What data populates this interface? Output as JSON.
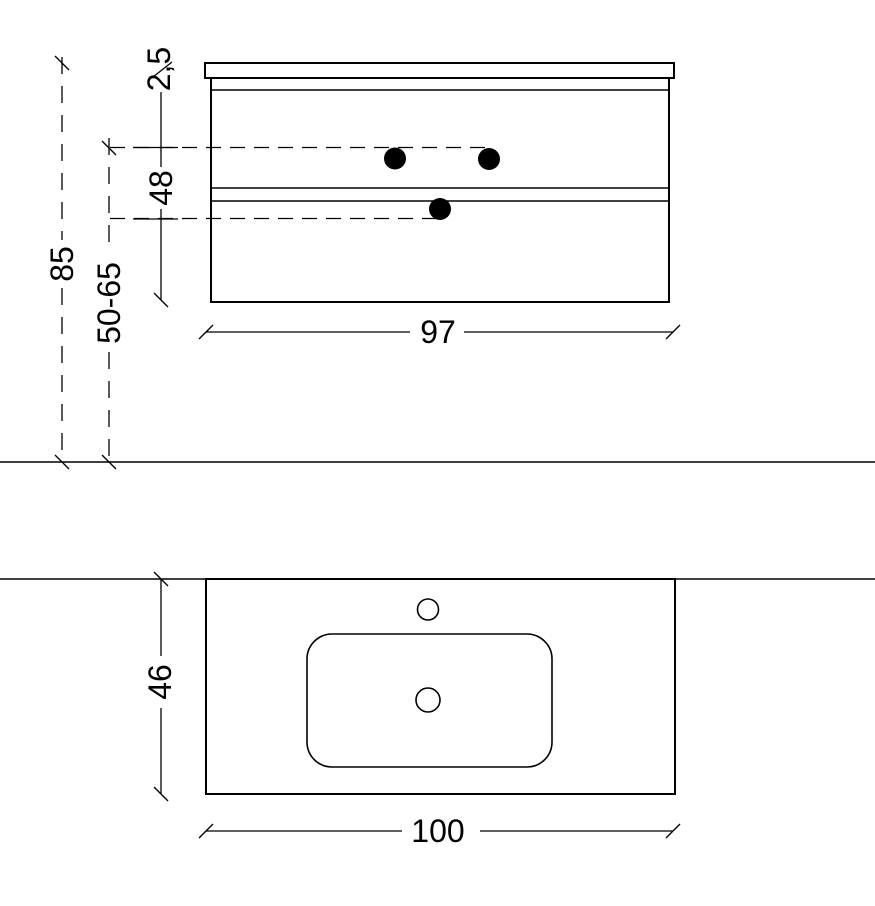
{
  "front_view": {
    "top_thickness": "2,5",
    "carcass_height": "48",
    "total_height": "85",
    "mounting_height_range": "50-65",
    "cabinet_width": "97"
  },
  "plan_view": {
    "depth": "46",
    "width": "100"
  },
  "colors": {
    "line": "#000000",
    "dot": "#000000",
    "background": "#ffffff"
  }
}
